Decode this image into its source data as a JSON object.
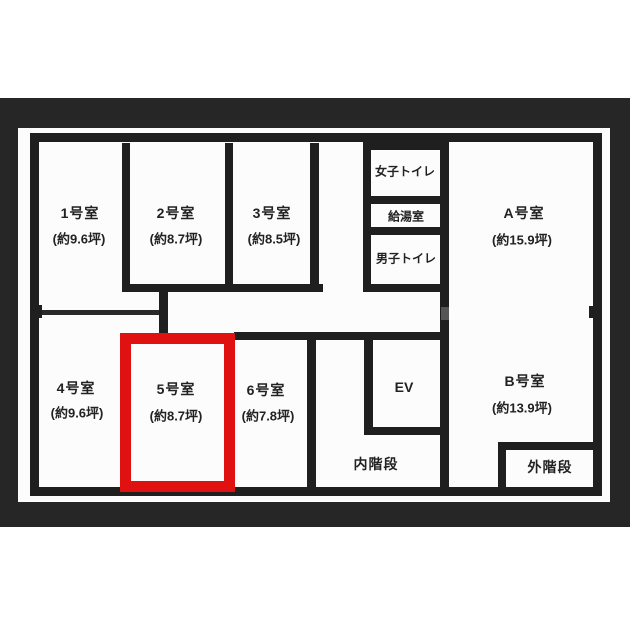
{
  "floorplan": {
    "rooms": [
      {
        "name": "1号室",
        "size": "(約9.6坪)"
      },
      {
        "name": "2号室",
        "size": "(約8.7坪)"
      },
      {
        "name": "3号室",
        "size": "(約8.5坪)"
      },
      {
        "name": "4号室",
        "size": "(約9.6坪)"
      },
      {
        "name": "5号室",
        "size": "(約8.7坪)"
      },
      {
        "name": "6号室",
        "size": "(約7.8坪)"
      },
      {
        "name": "A号室",
        "size": "(約15.9坪)"
      },
      {
        "name": "B号室",
        "size": "(約13.9坪)"
      }
    ],
    "highlighted_room": "5号室",
    "facilities": {
      "womens_toilet": "女子トイレ",
      "kitchenette": "給湯室",
      "mens_toilet": "男子トイレ",
      "elevator": "EV",
      "inner_staircase": "内階段",
      "outer_staircase": "外階段"
    },
    "colors": {
      "highlight_red": "#e01111",
      "wall_black": "#1f1f1f",
      "photo_background": "#262626"
    }
  }
}
